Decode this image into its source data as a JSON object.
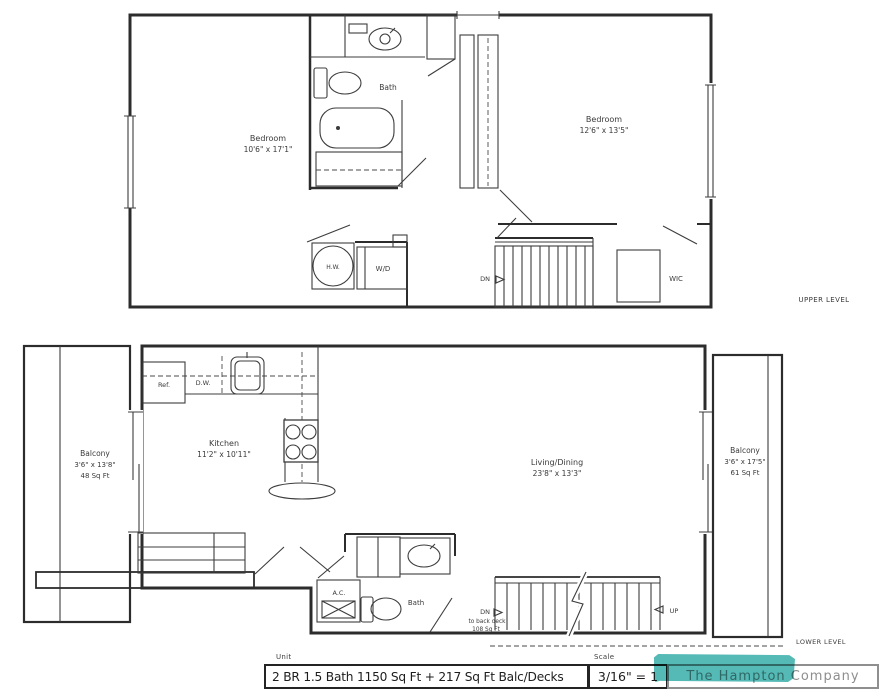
{
  "upper_level": {
    "caption": "UPPER LEVEL",
    "bedroom_left": {
      "name": "Bedroom",
      "dims": "10'6\" x 17'1\""
    },
    "bedroom_right": {
      "name": "Bedroom",
      "dims": "12'6\" x 13'5\""
    },
    "bath_label": "Bath",
    "hw_label": "H.W.",
    "wd_label": "W/D",
    "dn_label": "DN",
    "wic_label": "WIC"
  },
  "lower_level": {
    "caption": "LOWER LEVEL",
    "balcony_left": {
      "name": "Balcony",
      "dims": "3'6\" x 13'8\"",
      "area": "48 Sq Ft"
    },
    "balcony_right": {
      "name": "Balcony",
      "dims": "3'6\" x 17'5\"",
      "area": "61 Sq Ft"
    },
    "kitchen": {
      "name": "Kitchen",
      "dims": "11'2\" x 10'11\""
    },
    "living_dining": {
      "name": "Living/Dining",
      "dims": "23'8\" x 13'3\""
    },
    "ref_label": "Ref.",
    "dw_label": "D.W.",
    "ac_label": "A.C.",
    "bath_label": "Bath",
    "stairs": {
      "dn_label": "DN",
      "dn_note_line1": "to back deck",
      "dn_note_line2": "108 Sq Ft",
      "up_label": "UP"
    }
  },
  "title_block": {
    "unit_label": "Unit",
    "unit_value": "2 BR 1.5 Bath  1150 Sq Ft + 217 Sq Ft Balc/Decks",
    "scale_label": "Scale",
    "scale_value": "3/16\" = 1",
    "company": "The Hampton Company",
    "watermark_color": "#2AA9A4"
  }
}
